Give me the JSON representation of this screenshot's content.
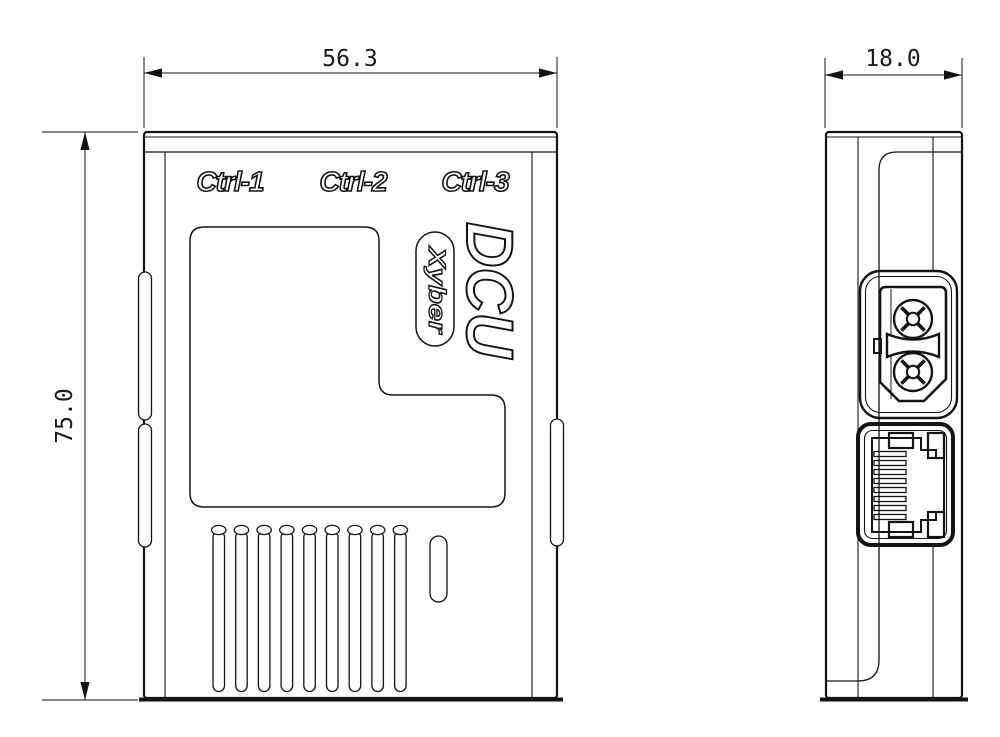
{
  "title": "DCU enclosure dimension drawing",
  "colors": {
    "background": "#ffffff",
    "line": "#141414"
  },
  "dimensions": {
    "width": "56.3",
    "height": "75.0",
    "depth": "18.0"
  },
  "front": {
    "port_labels": [
      "Ctrl-1",
      "Ctrl-2",
      "Ctrl-3"
    ],
    "logo": "DCU",
    "brand": "Xyber",
    "vents": {
      "count": 9
    }
  },
  "side": {
    "connectors": [
      "xt30-power-connector",
      "rj45-ethernet-port"
    ],
    "rj45_pin_count": 8
  }
}
